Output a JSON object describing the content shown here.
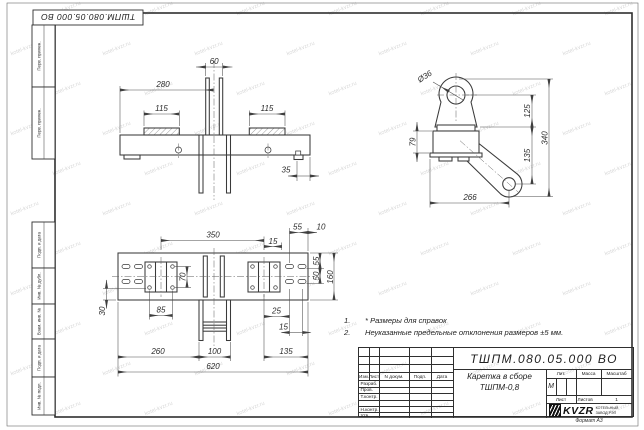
{
  "sheet": {
    "stamp_rotated": "ТШПМ.080.05.000  ВО",
    "watermark_text": "kotel-kvzr.ru",
    "side_labels": {
      "perv_primen_1": "Перв. примен.",
      "perv_primen_2": "Перв. примен.",
      "podp_data_1": "Подп. и дата",
      "inv_dubl": "Инв. № дубл.",
      "vzam_inv": "Взам. инв. №",
      "podp_data_2": "Подп. и дата",
      "inv_podl": "Инв. № подл."
    },
    "format_label": "Формат А3"
  },
  "notes": {
    "n1_num": "1.",
    "n1_text": "* Размеры для справок",
    "n2_num": "2.",
    "n2_text": "Неуказанные предельные отклонения размеров  ±5 мм."
  },
  "views": {
    "top": {
      "d280": "280",
      "d60": "60",
      "d115l": "115",
      "d115r": "115",
      "d35": "35"
    },
    "side": {
      "dia": "Ø36",
      "d125": "125",
      "d135": "135",
      "d340": "340",
      "d79": "79",
      "d266": "266"
    },
    "plan": {
      "d350": "350",
      "d15t": "15",
      "d55t": "55",
      "d10": "10",
      "d55r": "55",
      "d50": "50",
      "d160": "160",
      "d70": "70",
      "d85": "85",
      "d30": "30",
      "d25": "25",
      "d15b": "15",
      "d260": "260",
      "d100": "100",
      "d135": "135",
      "d620": "620"
    }
  },
  "title_block": {
    "doc_number": "ТШПМ.080.05.000  ВО",
    "name_line1": "Каретка в сборе",
    "name_line2": "ТШПМ-0,8",
    "col_izm": "Изм.",
    "col_list": "Лист",
    "col_ndoc": "N докум.",
    "col_podp": "Подп.",
    "col_data": "Дата",
    "row_razrab": "Разраб.",
    "row_prov": "Пров.",
    "row_tkontr": "Т.контр.",
    "row_nkontr": "Н.контр.",
    "row_utv": "Утв.",
    "lit_header": "Лит.",
    "lit_value": "М",
    "massa_header": "Масса",
    "masshtab_header": "Масштаб",
    "list_label": "Лист",
    "listov_label": "Листов",
    "listov_value": "1",
    "logo_text": "KVZR",
    "logo_line1": "КОТЕЛЬНЫЙ",
    "logo_line2": "ЗАВОД РЭП"
  },
  "colors": {
    "line": "#3a3a3a",
    "dim_line": "#4a4a4a",
    "watermark": "#b9b9b9"
  }
}
